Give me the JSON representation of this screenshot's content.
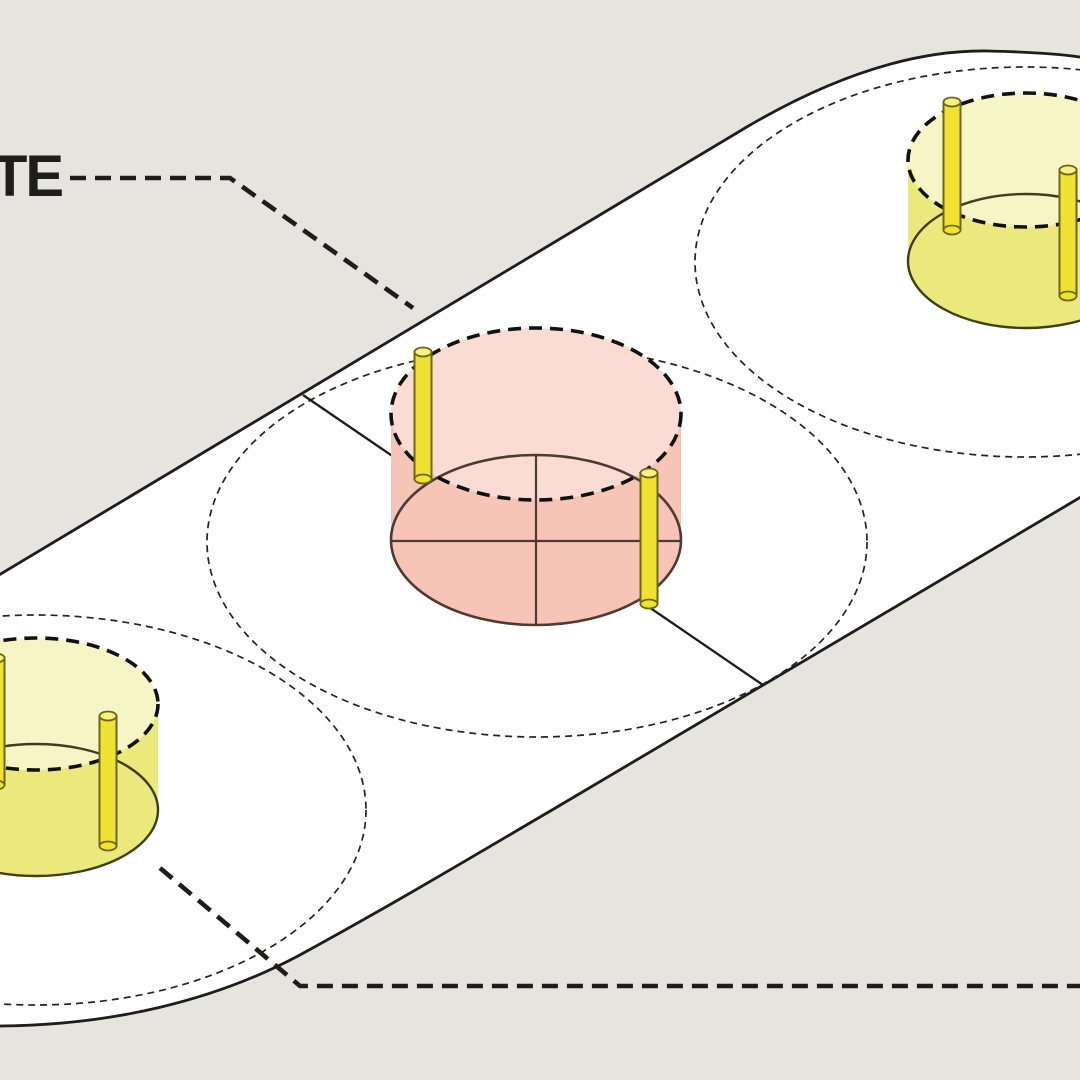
{
  "label": {
    "text": "TE"
  },
  "colors": {
    "background": "#e6e4df",
    "surface": "#ffffff",
    "line_dark": "#1d1d1b",
    "zone_dash": "#242424",
    "pink_light": "#fbdcd5",
    "pink_dark": "#f7c4b8",
    "pink_stroke": "#4c3a34",
    "yellow_light": "#f7f5c6",
    "yellow_dark": "#ebe97b",
    "yellow_stroke": "#3e3d20",
    "pole_fill": "#f0e233",
    "pole_cap": "#f9f282",
    "pole_stroke": "#6e6715",
    "label_color": "#1d1d1b"
  },
  "diagram": {
    "type": "axonometric-site-diagram",
    "site": {
      "shape": "capsule-stadium-plate",
      "orientation_deg": -30,
      "fill": "white",
      "outline": "solid black"
    },
    "zones": [
      {
        "id": "zone-1",
        "position": "lower-left",
        "boundary": "thin dashed ellipse",
        "cylinder": "yellow translucent",
        "poles": 2
      },
      {
        "id": "zone-2",
        "position": "center",
        "boundary": "thin dashed ellipse",
        "cylinder": "pink translucent",
        "poles": 2,
        "crosshair": true,
        "axis_line": true
      },
      {
        "id": "zone-3",
        "position": "upper-right",
        "boundary": "thin dashed ellipse",
        "cylinder": "yellow translucent",
        "poles": 2
      }
    ],
    "callouts": [
      {
        "id": "top-leader",
        "label": "TE",
        "style": "bold dashed leader line",
        "points_to": "site plate edge near center zone"
      },
      {
        "id": "bottom-leader",
        "label": "",
        "style": "bold dashed leader line",
        "points_to": "lower-left zone, running to right edge"
      }
    ]
  }
}
